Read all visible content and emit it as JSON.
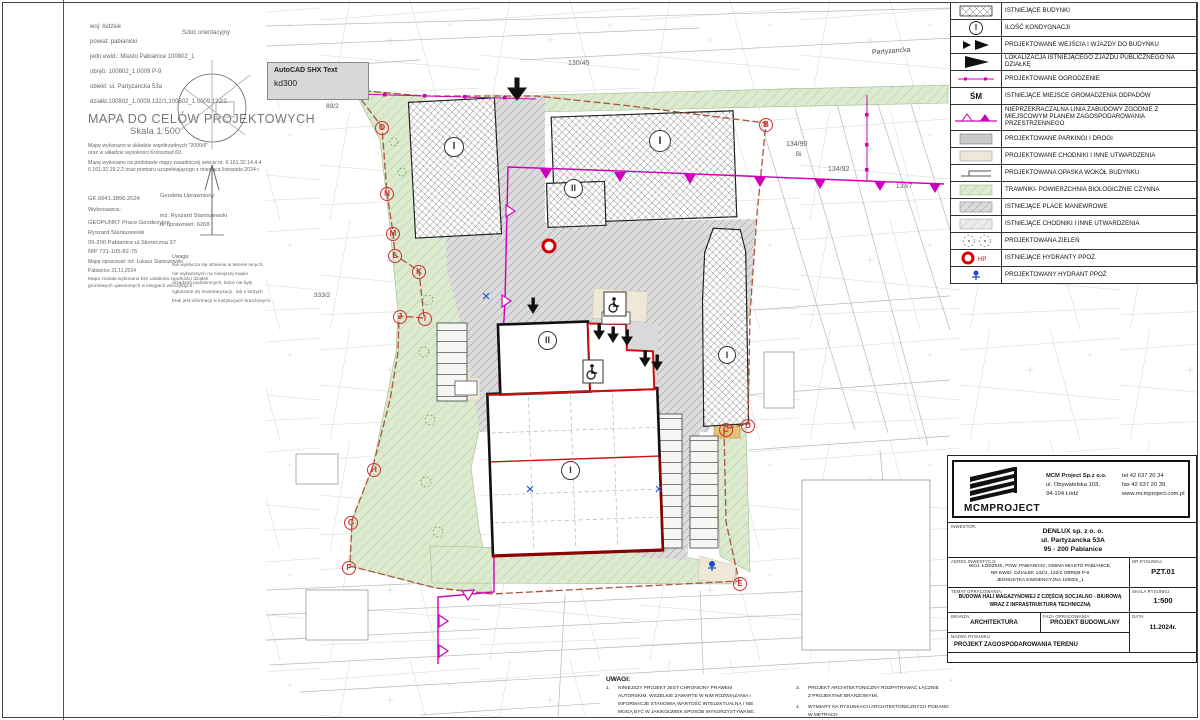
{
  "colors": {
    "magenta": "#cf00b7",
    "boundary": "#a8543a",
    "red": "#cc2222",
    "dark_red": "#8b0000",
    "green": "#dcead0",
    "blue": "#1f4bc4"
  },
  "tooltip": {
    "title": "AutoCAD SHX Text",
    "value": "kd300"
  },
  "map_info": {
    "rows": [
      "woj: łódzkie",
      "powiat: pabianicki",
      "jedn.ewid.: Miasto Pabianice 100802_1",
      "obręb: 100802_1.0009  P-9",
      "obiekt: ul. Partyzancka 53a",
      "działki:100802_1.0009.132/1,100802_1.0009.132/2"
    ],
    "title": "MAPA DO CELÓW PROJEKTOWYCH",
    "subtitle": "Skala 1:500",
    "notes": [
      "Mapę wykonano w układzie współrzędnych \"2000/6\"",
      "oraz w układzie wysokości Kronsztad 60.",
      "Mapę wykonano na podstawie mapy zasadniczej sekcje nr: 6.161.32.14.4.4",
      "6.161.32.19.2.2 oraz pomiaru uzupełniającego z miesiąca listopada 2024 r."
    ],
    "exec": [
      "GK.6641.3856.2024",
      "Wykonawca:",
      "GEOPUNKT Prace Geodezyjne",
      "Ryszard Staniszewski",
      "95-200 Pabianice ul.Słoneczna 37",
      "NIP 731-105-82-75",
      "Mapę opracował: inż. Łukasz Staniszewski",
      "Pabianice 21.11.2024",
      "Mapa została wykonana bez ustalenia zgodności działek",
      "gruntowych ujawnionych w księgach wieczystych"
    ],
    "surveyor": [
      "Geodeta Uprawniony",
      "inż. Ryszard Staniszewski",
      "nr uprawnień: 6268"
    ],
    "uwaga_label": "Uwaga:",
    "uwaga": [
      "Nie wyklucza się istnienia w terenie innych,",
      "nie wykazanych na niniejszej mapie",
      "urządzeń podziemnych, które nie były",
      "zgłoszone do inwentaryzacji , lub o których",
      "brak jest informacji w instytucjach branżowych."
    ],
    "sketch_label": "Szkic orientacyjny"
  },
  "legend": {
    "items": [
      {
        "label": "ISTNIEJĄCE BUDYNKI"
      },
      {
        "symbol": "I",
        "label": "ILOŚĆ KONDYGNACJI"
      },
      {
        "label": "PROJEKTOWANE WEJŚCIA I WJAZDY DO BUDYNKU"
      },
      {
        "label": "LOKALIZACJA ISTNIEJĄCEGO ZJAZDU PUBLICZNEGO NA DZIAŁKĘ"
      },
      {
        "label": "PROJEKTOWANE OGRODZENIE"
      },
      {
        "symbol": "ŚM",
        "label": "ISTNIEJĄCE MIEJSCE GROMADZENIA ODPADÓW"
      },
      {
        "label": "NIEPRZEKRACZALNA LINIA ZABUDOWY  ZGODNIE Z MIEJSCOWYM PLANEM ZAGOSPODAROWANIA PRZESTRZENNEGO"
      },
      {
        "label": "PROJEKTOWANE PARKINGI I DROGI"
      },
      {
        "label": "PROJEKTOWANE CHODNIKI I INNE UTWARDZENIA"
      },
      {
        "label": "PROJEKTOWANA OPASKA WOKÓŁ BUDYNKU"
      },
      {
        "label": "TRAWNIKI- POWIERZCHNIA BIOLOGICZNIE CZYNNA"
      },
      {
        "label": "ISTNIEJĄCE PLACE MANEWROWE"
      },
      {
        "label": "ISTNIEJĄCE CHODNIKI I INNE UTWARDZENIA"
      },
      {
        "label": "PROJEKTOWANA ZIELEŃ"
      },
      {
        "symbol": "HP",
        "label": "ISTNIEJĄCE HYDRANTY PPOŻ."
      },
      {
        "label": "PROJEKTOWANY HYDRANT PPOŻ"
      }
    ]
  },
  "drawing": {
    "letters": [
      "A",
      "B",
      "C",
      "D",
      "E",
      "F",
      "G",
      "H",
      "I",
      "J",
      "K",
      "L",
      "M",
      "N",
      "O"
    ],
    "buildings": {
      "b1": {
        "storeys": "I",
        "l1": "IST. HALA MAGAZYNOWA",
        "l2": "PM, Q<500 MJ/m2"
      },
      "b2": {
        "storeys": "I",
        "l1": "IST. HALA MAGAZYNOWA",
        "l2": "PM, Q<500 MJ/m2"
      },
      "b3": {
        "storeys": "II",
        "l1": "IST. BUD. BIUROWY",
        "l2": "ZLIII"
      },
      "b4": {
        "storeys": "I",
        "l1": "IST. BUD. BIUROWY",
        "l2": "ZLIII"
      },
      "office": {
        "storeys": "II",
        "l1": "CZĘŚĆ BIUROWA",
        "l2": "ZLIII"
      },
      "hall": {
        "storeys": "I",
        "l1": "HALA MAGAZYNOWA",
        "l2": "PM,1000<Q<2000 MJ/m2",
        "l3": "± 0,00 = 177,40 m n.p.m."
      }
    },
    "annotations": {
      "p10": "10 mp",
      "p19": "19 mp",
      "p13": "13 mp",
      "p4": "4 mp",
      "sm": "ŚM",
      "hp": "HP",
      "tir": "manewrowania TIRa",
      "parking_okresowy": "parking okresowy",
      "street": "Partyzancka",
      "river": "rz. Dobrzynka",
      "level": "177,36"
    },
    "parcels": {
      "a": "130/45",
      "b": "134/90",
      "c": "Bi",
      "d": "134/92",
      "e": "133/7",
      "f": "88/2",
      "g": "333/2",
      "h": "135/2"
    }
  },
  "title_block": {
    "logo_text": "MCMPROJECT",
    "company": [
      "MCM Project Sp.z o.o.",
      "ul. Obywatelska 103,",
      "94-104 Łódź"
    ],
    "contact": [
      "tel 42 637 20 34",
      "fax 42 637 20 39,",
      "www.mcmproject.com.pl"
    ],
    "investor_label": "INWESTOR:",
    "investor": [
      "DENLUX sp. z o. o.",
      "ul. Partyzancka 53A",
      "95 - 200 Pabianice"
    ],
    "address_label": "ADRES INWESTYCJI:",
    "address": [
      "WOJ. ŁÓDZKIE, POW. PABIANICKI, GMINA MIASTO PABIANICE,",
      "NR EWID. DZIAŁEK 132/1, 132/2 OBRĘB P-9",
      "JEDNOSTKA EWIDENCYJNA 100802_1"
    ],
    "drawing_no_label": "NR RYSUNKU:",
    "drawing_no": "PZT.01",
    "subject_label": "TEMAT OPRACOWANIA:",
    "subject": [
      "BUDOWA HALI MAGAZYNOWEJ Z CZĘŚCIĄ SOCJALNO - BIUROWĄ",
      "WRAZ Z INFRASTRUKTURĄ TECHNICZNĄ"
    ],
    "scale_label": "SKALA RYSUNKU:",
    "scale": "1:500",
    "branch_label": "BRANŻA:",
    "branch": "ARCHITEKTURA",
    "phase_label": "FAZA OPRACOWANIA:",
    "phase": "PROJEKT BUDOWLANY",
    "date_label": "DATA:",
    "date": "11.2024r.",
    "name_label": "NAZWA RYSUNKU:",
    "name": "PROJEKT ZAGOSPODAROWANIA TERENU"
  },
  "uwagi": {
    "label": "UWAGI:",
    "n1": "1.",
    "i1": [
      "NINIEJSZY PROJEKT JEST CHRONIONY PRAWEM",
      "AUTORSKIM. WSZELKIE ZAWARTE W NIM ROZWIĄZANIA I",
      "INFORMACJE STANOWIĄ WARTOŚĆ INTELEKTUALNĄ I NIE",
      "MOGĄ BYĆ W JAKIKOLWIEK SPOSÓB WYKORZYSTYWANE,"
    ],
    "n3": "3.",
    "i3": [
      "PROJEKT ARCHITEKTONICZNY ROZPATRYWAĆ ŁĄCZNIE",
      "Z PROJEKTAMI BRANŻOWYMI."
    ],
    "n4": "4.",
    "i4": [
      "WYMIARY NA RYSUNKACH ARCHITEKTONICZNYCH PODANO",
      "W METRACH"
    ]
  }
}
